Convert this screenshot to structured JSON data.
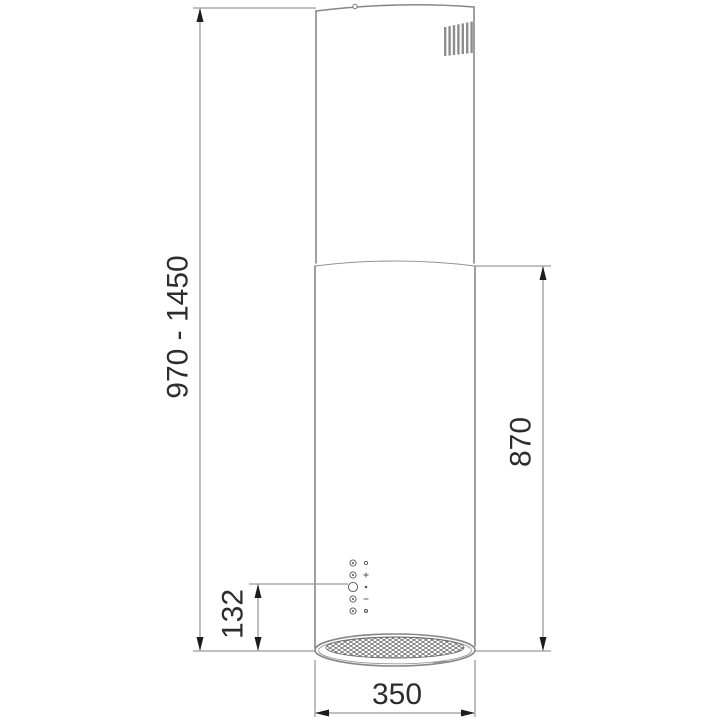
{
  "drawing": {
    "labels": {
      "overall_height_range": "970 - 1450",
      "body_height": "870",
      "control_panel_offset": "132",
      "diameter": "350"
    },
    "icons": [
      "vent-louver-icon",
      "control-panel-buttons-icon",
      "filter-grille-icon",
      "screw-hole-icon"
    ],
    "colors": {
      "background": "#ffffff",
      "outline": "#878787",
      "dimension_line": "#9a9a9a",
      "arrowhead": "#1c1c1c",
      "label_text": "#2d2d2d",
      "mesh": "#4f4f4f"
    }
  }
}
